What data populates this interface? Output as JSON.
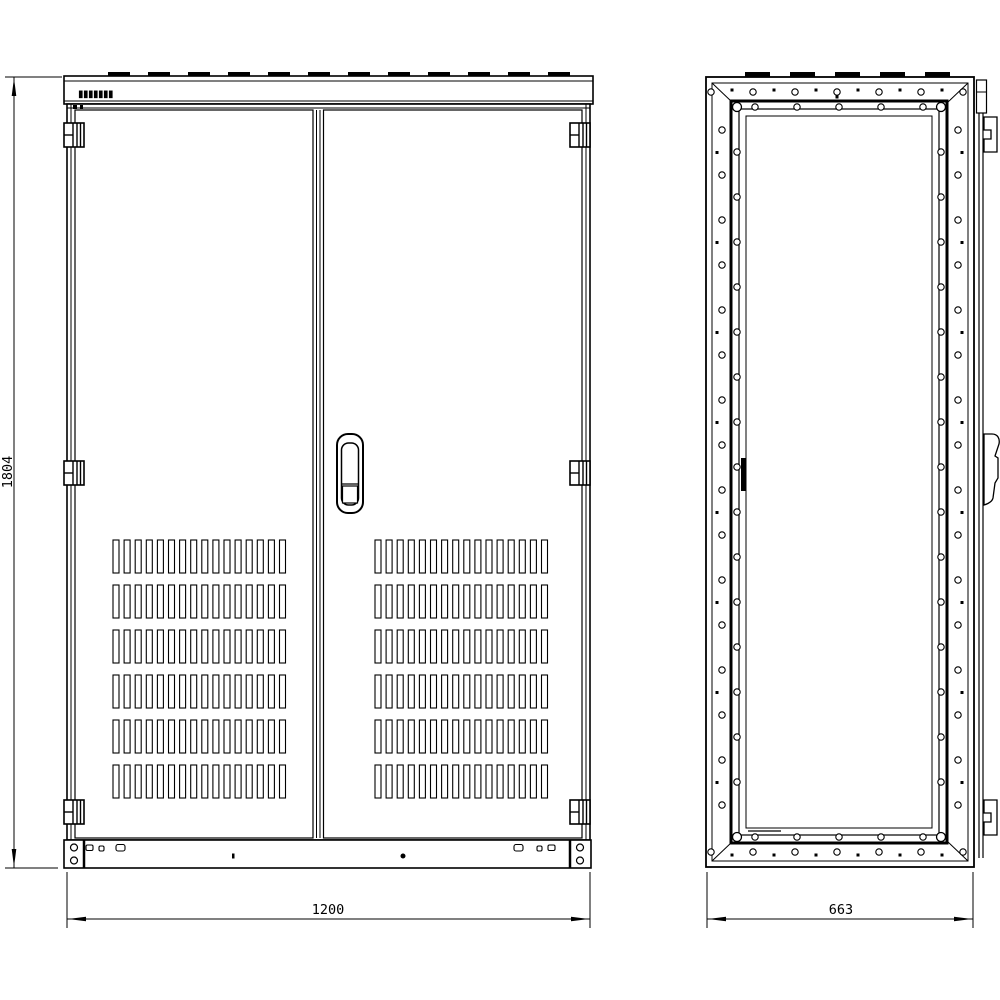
{
  "drawing": {
    "background_color": "#ffffff",
    "line_color": "#000000",
    "nameplate_text": "▮▮▮▮▮▮▮",
    "dimensions": {
      "height": "1804",
      "width": "1200",
      "depth": "663"
    },
    "front_view": {
      "doors": 2,
      "hinges_per_side": 3,
      "vent_groups": 2,
      "vent_rows_per_group": 6,
      "vent_slats_per_row": 16
    },
    "side_view": {
      "corner_screws": 4
    }
  }
}
